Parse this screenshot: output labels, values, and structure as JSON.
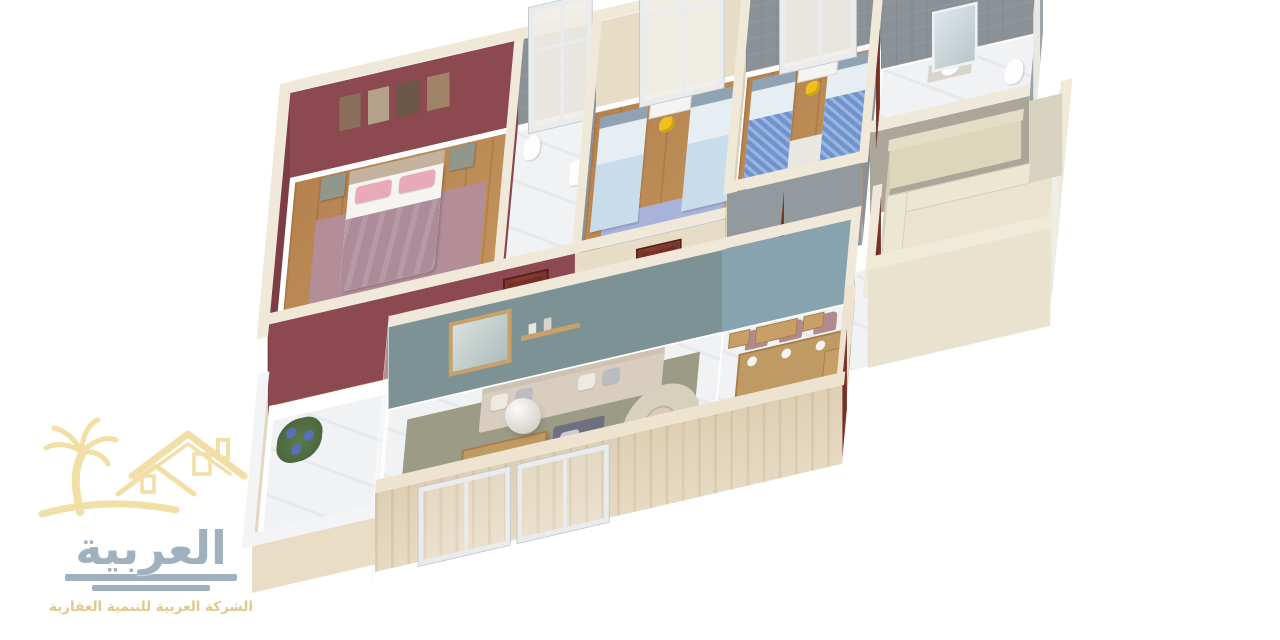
{
  "meta": {
    "background": "#ffffff",
    "description_visible_text_language": "Arabic"
  },
  "logo": {
    "brand_name": "العربية",
    "tagline": "الشركة العربية للتنمية العقارية",
    "mark": "palm-tree-and-houses"
  },
  "colors": {
    "logo-gray": "#9fb0bf",
    "logo-gold": "#f2dfa6",
    "logo-gold-text": "#dfc98e",
    "wood-floor": "#b5824f",
    "marble-white": "#f1f2f4",
    "maroon-wall": "#8c4a50",
    "maroon-wall-dark": "#7c3d44",
    "cream-wall": "#e7dcc6",
    "tile-gray": "#8b9297",
    "bluegray-wall": "#87a3b0",
    "graygreen-wall": "#7d9294",
    "door-red": "#7e3026",
    "accent-yellow": "#f0c11e",
    "teal-pillow": "#3fd2c8",
    "sofa-gray": "#6e7080",
    "sofa-beige": "#d9cdbf",
    "dining-chair-mauve": "#b08a8e",
    "table-wood": "#c09a64",
    "kids-bed-blue": "#c9dcec",
    "kids-bed-pattern": "#6f93cf",
    "master-blanket": "#ad8b99",
    "living-rug": "#9c9b86",
    "kids-rug-blue": "#a9b3da",
    "master-rug": "#b38d98",
    "exterior-band": "#decfb4",
    "kitchen-cabinet": "#ece7d2"
  },
  "scene": {
    "type": "isometric-3d-floor-plan",
    "rooms": [
      {
        "id": "master-bedroom",
        "name": "Master bedroom",
        "features": [
          "double bed",
          "2 nightstands with lamps",
          "bench",
          "dresser with mirror",
          "wall picture frames",
          "mauve rug",
          "yellow chair",
          "maroon walls",
          "wood floor"
        ]
      },
      {
        "id": "master-ensuite",
        "name": "Master ensuite bathroom",
        "features": [
          "toilet",
          "wash basin",
          "gray tiled walls",
          "marble floor",
          "window"
        ]
      },
      {
        "id": "kids-bedroom-1",
        "name": "Kids bedroom 1",
        "features": [
          "2 single beds",
          "desk",
          "yellow chair",
          "blue rug",
          "wardrobe",
          "window",
          "cream walls"
        ]
      },
      {
        "id": "kids-bedroom-2",
        "name": "Kids bedroom 2",
        "features": [
          "2 single beds with patterned blue covers",
          "desk",
          "yellow chair",
          "dresser",
          "white rug",
          "gray walls",
          "window"
        ]
      },
      {
        "id": "bathroom",
        "name": "Shared bathroom",
        "features": [
          "wash basin counter",
          "toilet",
          "mirror",
          "gray tiled walls",
          "window"
        ]
      },
      {
        "id": "kitchen",
        "name": "Kitchen",
        "features": [
          "L-shaped cream cabinets",
          "upper cabinets",
          "window",
          "open wooden door"
        ]
      },
      {
        "id": "living-room",
        "name": "Living room",
        "features": [
          "gray corner sofa with teal pillows",
          "beige sofa",
          "wooden coffee table",
          "round rug with side table",
          "white pendant ball lamp",
          "wall mirror and shelf",
          "TV panel"
        ]
      },
      {
        "id": "dining-room",
        "name": "Dining room",
        "features": [
          "wooden table with place settings",
          "6 mauve chairs",
          "console with mirror",
          "2 bookshelves",
          "sideboard",
          "blue-gray wall"
        ]
      },
      {
        "id": "balcony",
        "name": "Balcony",
        "features": [
          "marble floor",
          "parapet",
          "flowering plants"
        ]
      },
      {
        "id": "corridor",
        "name": "Corridor",
        "features": [
          "wooden doors",
          "wood and marble floor"
        ]
      }
    ]
  }
}
